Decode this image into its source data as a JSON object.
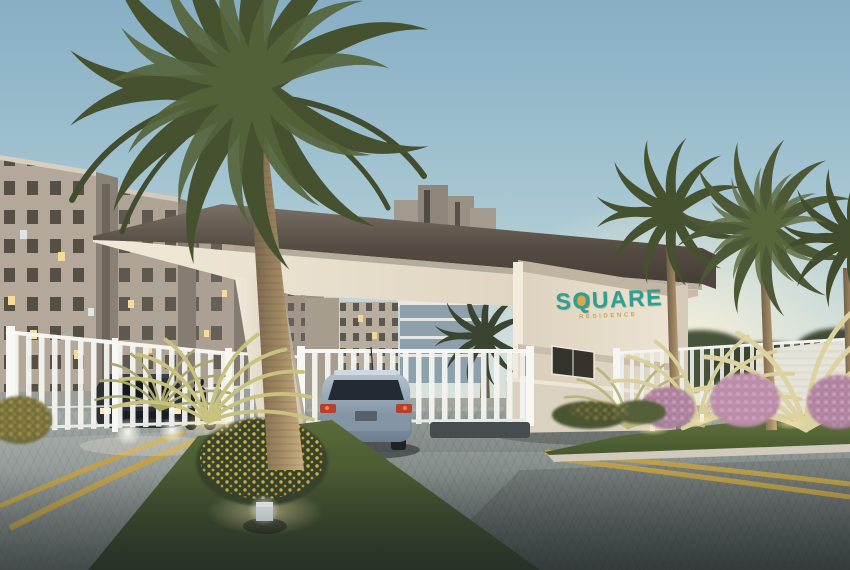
{
  "scene": {
    "title": "Residential condominium gated entrance at dusk",
    "logo": {
      "text": "SQUARE",
      "tagline": "RESIDENCE",
      "text_color": "#2ba195",
      "square_accent_color": "#d9a84a",
      "tagline_color": "#c8a457"
    },
    "colors": {
      "sky_top": "#87aec4",
      "sky_horizon": "#ece5d2",
      "canopy_fascia": "#574e45",
      "canopy_soffit": "#ece3d2",
      "gatehouse_wall": "#e7decd",
      "gate_white": "#f3f4f0",
      "apartment_wall": "#b4a89a",
      "pavement": "#8a928f",
      "lane_line_yellow": "#c7a23f",
      "grass": "#4c5c34",
      "palm_frond": "#4c5836",
      "palm_trunk": "#a98f6b",
      "shrub_pink": "#c49ab3",
      "shrub_yellow": "#ddb74e",
      "car_entering_body": "#9db0bf",
      "car_exiting_body": "#2c3036"
    }
  }
}
